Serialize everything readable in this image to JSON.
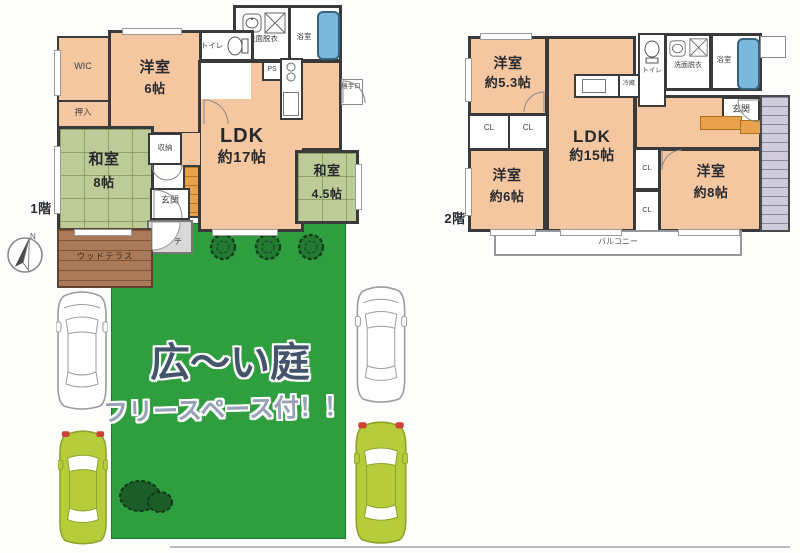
{
  "floor1": {
    "floor_label": "1階",
    "rooms": {
      "wic": "WIC",
      "western6": {
        "name": "洋室",
        "size": "6帖"
      },
      "oshiire": "押入",
      "japanese8": {
        "name": "和室",
        "size": "8帖"
      },
      "ldk": {
        "name": "LDK",
        "size": "約17帖"
      },
      "japanese45": {
        "name": "和室",
        "size": "4.5帖"
      }
    },
    "labels": {
      "storage_top": "収納",
      "toilet": "トイレ",
      "washroom": "洗面脱衣",
      "bathroom": "浴室",
      "ps": "PS",
      "back_door": "勝手口",
      "storage_mid": "収納",
      "entrance": "玄関",
      "porch": "ポーチ",
      "wood_terrace": "ウッドテラス"
    }
  },
  "floor2": {
    "floor_label": "2階",
    "rooms": {
      "western53": {
        "name": "洋室",
        "size": "約5.3帖"
      },
      "western6": {
        "name": "洋室",
        "size": "約6帖"
      },
      "ldk": {
        "name": "LDK",
        "size": "約15帖"
      },
      "western8": {
        "name": "洋室",
        "size": "約8帖"
      }
    },
    "labels": {
      "cl": [
        "CL",
        "CL",
        "CL",
        "CL"
      ],
      "toilet": "トイレ",
      "washroom": "洗面脱衣",
      "bathroom": "浴室",
      "fridge": "冷蔵",
      "entrance": "玄関",
      "balcony": "バルコニー"
    }
  },
  "garden": {
    "headline": "広〜い庭",
    "subline": "フリースペース付！！"
  },
  "compass": {
    "north": "N"
  },
  "colors": {
    "room_fill": "#f5c7a0",
    "tatami_fill": "#bccb97",
    "garden_green": "#2f9e3f",
    "terrace_brown": "#aa7a59",
    "wall": "#3a3a3a",
    "bathtub_blue": "#7bb8dc",
    "stair_orange": "#e9a14c",
    "car_green": "#b7cc3b"
  }
}
